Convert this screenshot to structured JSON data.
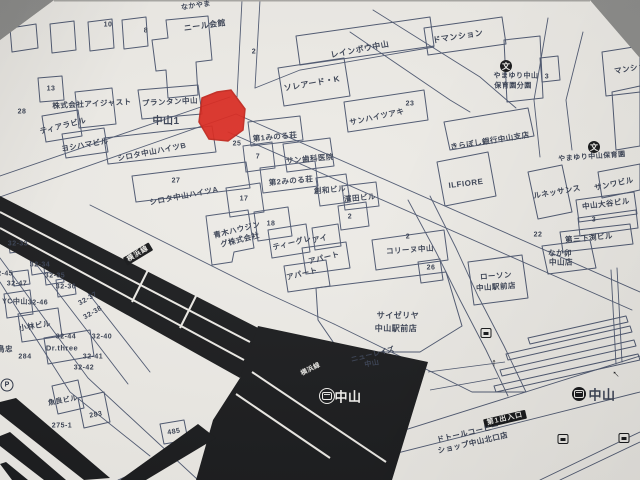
{
  "photo": {
    "background_color": "#8f8f8d",
    "paper_color": "#edebe6"
  },
  "map": {
    "ink_color": "#3a4254",
    "line_color": "#4e5870",
    "rail_color": "#1b1c1e",
    "marker_color": "#da251b",
    "station": {
      "name": "中山",
      "line": "横浜線",
      "exit": "第1出入口"
    },
    "labels": [
      {
        "t": "なかやま",
        "x": 196,
        "y": 6,
        "s": 7,
        "r": -8
      },
      {
        "t": "ニール会館",
        "x": 205,
        "y": 26,
        "s": 8,
        "r": -8
      },
      {
        "t": "10",
        "x": 108,
        "y": 25,
        "s": 7
      },
      {
        "t": "8",
        "x": 146,
        "y": 31,
        "s": 7
      },
      {
        "t": "2",
        "x": 254,
        "y": 52,
        "s": 7
      },
      {
        "t": "レインボウ中山",
        "x": 360,
        "y": 50,
        "s": 8,
        "r": -11
      },
      {
        "t": "ソレアード・K",
        "x": 312,
        "y": 84,
        "s": 8,
        "r": -10
      },
      {
        "t": "ドマンション",
        "x": 458,
        "y": 37,
        "s": 8,
        "r": -9
      },
      {
        "t": "やまゆり中山",
        "x": 516,
        "y": 76,
        "s": 7
      },
      {
        "t": "保育園分園",
        "x": 513,
        "y": 86,
        "s": 7
      },
      {
        "t": "3",
        "x": 547,
        "y": 77,
        "s": 7
      },
      {
        "t": "マンション",
        "x": 634,
        "y": 68,
        "s": 7.5,
        "r": -10
      },
      {
        "t": "株式会社アイジャスト",
        "x": 92,
        "y": 104,
        "s": 7.5,
        "r": -3
      },
      {
        "t": "13",
        "x": 51,
        "y": 89,
        "s": 7
      },
      {
        "t": "28",
        "x": 22,
        "y": 112,
        "s": 7
      },
      {
        "t": "プランタン中山",
        "x": 170,
        "y": 102,
        "s": 7.5,
        "r": -3
      },
      {
        "t": "中山1",
        "x": 166,
        "y": 122,
        "s": 10,
        "b": 1
      },
      {
        "t": "ティアラビル",
        "x": 63,
        "y": 126,
        "s": 7.5,
        "r": -14
      },
      {
        "t": "ヨシハマビル",
        "x": 85,
        "y": 145,
        "s": 7.5,
        "r": -10
      },
      {
        "t": "シロタ中山ハイツB",
        "x": 152,
        "y": 152,
        "s": 7.5,
        "r": -11
      },
      {
        "t": "27",
        "x": 176,
        "y": 181,
        "s": 7
      },
      {
        "t": "シロタ中山ハイツA",
        "x": 184,
        "y": 196,
        "s": 7.5,
        "r": -11
      },
      {
        "t": "25",
        "x": 237,
        "y": 144,
        "s": 7
      },
      {
        "t": "第1みのる荘",
        "x": 275,
        "y": 137,
        "s": 7.5,
        "r": -5
      },
      {
        "t": "7",
        "x": 258,
        "y": 157,
        "s": 7
      },
      {
        "t": "サン歯科医院",
        "x": 310,
        "y": 159,
        "s": 7.5,
        "r": -5
      },
      {
        "t": "第2みのる荘",
        "x": 291,
        "y": 181,
        "s": 7.5,
        "r": -5
      },
      {
        "t": "創和ビル",
        "x": 330,
        "y": 190,
        "s": 7.5,
        "r": -5
      },
      {
        "t": "濱田ビル",
        "x": 360,
        "y": 198,
        "s": 7.5,
        "r": -5
      },
      {
        "t": "2",
        "x": 350,
        "y": 217,
        "s": 7
      },
      {
        "t": "17",
        "x": 244,
        "y": 199,
        "s": 7
      },
      {
        "t": "18",
        "x": 271,
        "y": 224,
        "s": 7
      },
      {
        "t": "青木ハウジン",
        "x": 237,
        "y": 230,
        "s": 7.5,
        "r": -14
      },
      {
        "t": "グ株式会社",
        "x": 240,
        "y": 240,
        "s": 7.5,
        "r": -14
      },
      {
        "t": "ティーグレ",
        "x": 292,
        "y": 243,
        "s": 7.5,
        "r": -14
      },
      {
        "t": "アイ",
        "x": 320,
        "y": 239,
        "s": 7.5,
        "r": -14
      },
      {
        "t": "アパート",
        "x": 324,
        "y": 258,
        "s": 7.5,
        "r": -14
      },
      {
        "t": "アパート",
        "x": 302,
        "y": 274,
        "s": 7.5,
        "r": -14
      },
      {
        "t": "サンハイツアキ",
        "x": 377,
        "y": 117,
        "s": 7.5,
        "r": -12
      },
      {
        "t": "23",
        "x": 410,
        "y": 104,
        "s": 7
      },
      {
        "t": "きらぼし銀行中山支店",
        "x": 490,
        "y": 141,
        "s": 7.5,
        "r": -9
      },
      {
        "t": "ILFIORE",
        "x": 466,
        "y": 184,
        "s": 8,
        "b": 1,
        "r": -7
      },
      {
        "t": "やまゆり中山保育園",
        "x": 592,
        "y": 157,
        "s": 7,
        "r": -4
      },
      {
        "t": "サンワビル",
        "x": 614,
        "y": 184,
        "s": 7.5,
        "r": -12
      },
      {
        "t": "ルネッサンス",
        "x": 557,
        "y": 192,
        "s": 7.5,
        "r": -10
      },
      {
        "t": "中山大谷ビル",
        "x": 606,
        "y": 204,
        "s": 7.5,
        "r": -7
      },
      {
        "t": "3",
        "x": 594,
        "y": 220,
        "s": 7
      },
      {
        "t": "22",
        "x": 538,
        "y": 235,
        "s": 7
      },
      {
        "t": "第三下渕ビル",
        "x": 589,
        "y": 238,
        "s": 7.5,
        "r": -5
      },
      {
        "t": "なか卯",
        "x": 560,
        "y": 253,
        "s": 7.5
      },
      {
        "t": "中山店",
        "x": 561,
        "y": 262,
        "s": 7.5
      },
      {
        "t": "2",
        "x": 408,
        "y": 237,
        "s": 7
      },
      {
        "t": "コリーヌ中山",
        "x": 410,
        "y": 250,
        "s": 7.5,
        "r": -4
      },
      {
        "t": "26",
        "x": 431,
        "y": 268,
        "s": 7
      },
      {
        "t": "ローソン",
        "x": 496,
        "y": 276,
        "s": 7.5,
        "r": -4
      },
      {
        "t": "中山駅前店",
        "x": 496,
        "y": 287,
        "s": 7.5,
        "r": -4
      },
      {
        "t": "サイゼリヤ",
        "x": 398,
        "y": 316,
        "s": 8
      },
      {
        "t": "中山駅前店",
        "x": 396,
        "y": 329,
        "s": 8
      },
      {
        "t": "ニューレイズ",
        "x": 373,
        "y": 355,
        "s": 7,
        "r": -14
      },
      {
        "t": "中山",
        "x": 372,
        "y": 364,
        "s": 7,
        "r": -10
      },
      {
        "t": "鳥忠",
        "x": 5,
        "y": 349,
        "s": 7.5
      },
      {
        "t": "284",
        "x": 25,
        "y": 357,
        "s": 7
      },
      {
        "t": "YC中山",
        "x": 15,
        "y": 302,
        "s": 7
      },
      {
        "t": "32-46",
        "x": 38,
        "y": 303,
        "s": 7
      },
      {
        "t": "小林ビル",
        "x": 35,
        "y": 326,
        "s": 7.5,
        "r": -9
      },
      {
        "t": "Dr.three",
        "x": 62,
        "y": 348,
        "s": 7.5,
        "b": 1
      },
      {
        "t": "32-44",
        "x": 66,
        "y": 337,
        "s": 7
      },
      {
        "t": "32-40",
        "x": 102,
        "y": 337,
        "s": 7
      },
      {
        "t": "32-41",
        "x": 93,
        "y": 357,
        "s": 7
      },
      {
        "t": "32-42",
        "x": 84,
        "y": 368,
        "s": 7
      },
      {
        "t": "32-37",
        "x": 88,
        "y": 299,
        "s": 7,
        "r": -30
      },
      {
        "t": "32-38",
        "x": 93,
        "y": 313,
        "s": 7,
        "r": -30
      },
      {
        "t": "32-34",
        "x": 40,
        "y": 265,
        "s": 7
      },
      {
        "t": "32-35",
        "x": 55,
        "y": 276,
        "s": 7
      },
      {
        "t": "32-36",
        "x": 66,
        "y": 287,
        "s": 7
      },
      {
        "t": "32-47",
        "x": 17,
        "y": 284,
        "s": 7
      },
      {
        "t": "32-33",
        "x": 18,
        "y": 244,
        "s": 7
      },
      {
        "t": "32-45",
        "x": 3,
        "y": 274,
        "s": 7
      },
      {
        "t": "魚良ビル",
        "x": 63,
        "y": 401,
        "s": 7,
        "r": -10
      },
      {
        "t": "283",
        "x": 96,
        "y": 415,
        "s": 7,
        "r": -10
      },
      {
        "t": "275-1",
        "x": 62,
        "y": 426,
        "s": 7,
        "b": 1
      },
      {
        "t": "485",
        "x": 174,
        "y": 432,
        "s": 7,
        "r": -10
      },
      {
        "t": "中山",
        "x": 348,
        "y": 397,
        "s": 13,
        "b": 1,
        "c": "#f5f4f0"
      },
      {
        "t": "横浜線",
        "x": 311,
        "y": 370,
        "s": 6.5,
        "c": "#e8e7e3",
        "r": -27
      },
      {
        "t": "横浜線",
        "x": 138,
        "y": 254,
        "s": 7,
        "r": -31,
        "chip": 1
      },
      {
        "t": "第1出入口",
        "x": 505,
        "y": 419,
        "s": 7,
        "r": -13,
        "chip": 1
      },
      {
        "t": "ドトールコーヒー",
        "x": 468,
        "y": 433,
        "s": 7.5,
        "r": -13
      },
      {
        "t": "ショップ中山北口店",
        "x": 473,
        "y": 443,
        "s": 7.5,
        "r": -13
      },
      {
        "t": "中山",
        "x": 602,
        "y": 395,
        "s": 13,
        "b": 1
      }
    ],
    "icons": [
      {
        "n": "jr-station-icon",
        "x": 327,
        "y": 396,
        "variant": "light"
      },
      {
        "n": "jr-station-icon",
        "x": 579,
        "y": 394,
        "variant": "dark"
      },
      {
        "n": "school-icon",
        "x": 506,
        "y": 66,
        "g": "文"
      },
      {
        "n": "school-icon",
        "x": 594,
        "y": 147,
        "g": "文"
      },
      {
        "n": "parking-icon",
        "x": 7,
        "y": 385,
        "g": "P"
      },
      {
        "n": "bus-stop-icon",
        "x": 486,
        "y": 333
      },
      {
        "n": "bus-stop-icon",
        "x": 563,
        "y": 439
      },
      {
        "n": "bus-stop-icon",
        "x": 624,
        "y": 438
      },
      {
        "n": "arrow-up-icon",
        "x": 494,
        "y": 363,
        "g": "↑",
        "rot": 0
      },
      {
        "n": "arrow-up-icon",
        "x": 616,
        "y": 374,
        "g": "↑",
        "rot": -45
      }
    ]
  }
}
